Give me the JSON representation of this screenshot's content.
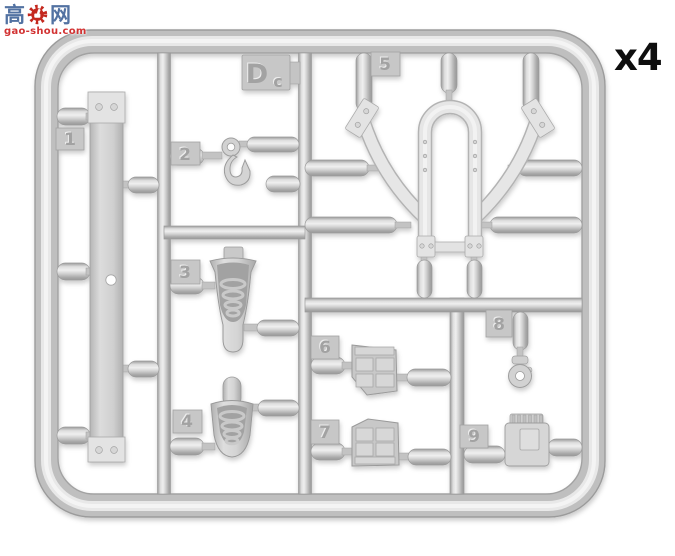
{
  "watermark": {
    "site_name_left": "高",
    "site_name_right": "网",
    "site_url": "gao-shou.com",
    "gear_icon": "red-gear-thumbs-up"
  },
  "quantity_label": "x4",
  "sprue": {
    "code": "Dc",
    "code_letter": "D",
    "code_suffix": "c",
    "part_numbers": [
      "1",
      "2",
      "3",
      "4",
      "5",
      "6",
      "7",
      "8",
      "9"
    ]
  },
  "colors": {
    "plastic_base": "#c6c6c6",
    "plastic_highlight": "#efefef",
    "plastic_shadow": "#9a9a9a",
    "part_light": "#e7e7e7",
    "watermark_blue": "#5272a2",
    "watermark_red": "#d23232",
    "label_black": "#0e0e0e",
    "background": "#ffffff"
  }
}
